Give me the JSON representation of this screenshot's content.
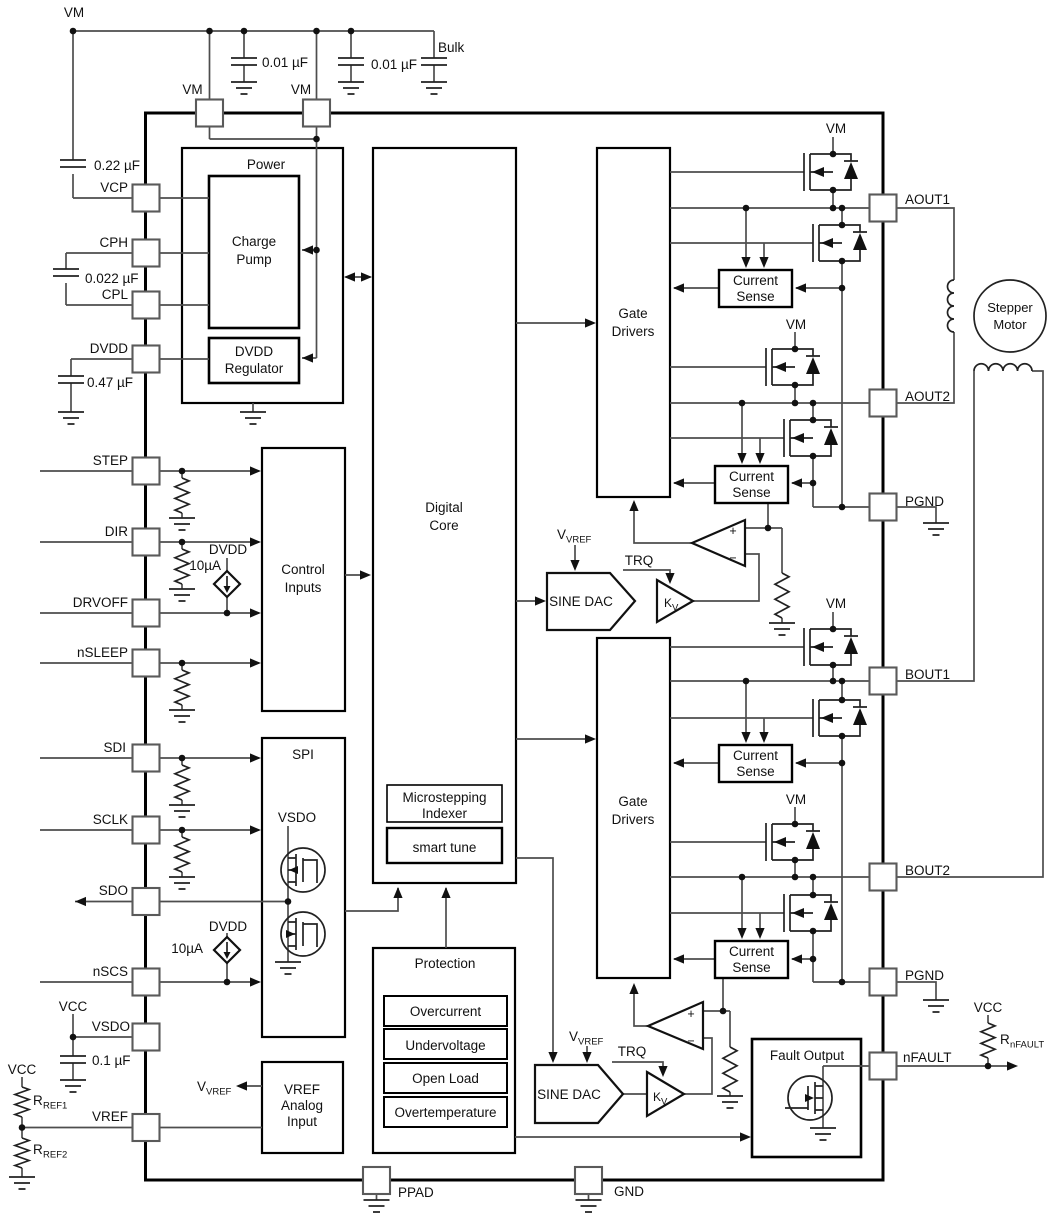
{
  "title": "Stepper motor driver functional block diagram",
  "colors": {
    "background": "#ffffff",
    "outline": "#000000",
    "wire": "#4d4d4d",
    "text": "#111111"
  },
  "labels": {
    "vm": "VM",
    "bulk": "Bulk",
    "vcc": "VCC",
    "dvdd": "DVDD",
    "i_src": "10µA",
    "trq": "TRQ",
    "plus": "+",
    "minus": "−"
  },
  "caps": {
    "c1": "0.01 µF",
    "c2": "0.01 µF",
    "c_vcp": "0.22 µF",
    "c_cp": "0.022 µF",
    "c_dvdd": "0.47 µF",
    "c_vsdo": "0.1 µF"
  },
  "pins": {
    "left": [
      "VCP",
      "CPH",
      "CPL",
      "DVDD",
      "STEP",
      "DIR",
      "DRVOFF",
      "nSLEEP",
      "SDI",
      "SCLK",
      "SDO",
      "nSCS",
      "VSDO",
      "VREF"
    ],
    "right": [
      "AOUT1",
      "AOUT2",
      "PGND",
      "BOUT1",
      "BOUT2",
      "PGND",
      "nFAULT"
    ],
    "top": [
      "VM",
      "VM"
    ],
    "bottom": [
      "PPAD",
      "GND"
    ]
  },
  "blocks": {
    "power": "Power",
    "charge_pump": [
      "Charge",
      "Pump"
    ],
    "dvdd_regulator": [
      "DVDD",
      "Regulator"
    ],
    "digital_core": [
      "Digital",
      "Core"
    ],
    "gate_drivers": [
      "Gate",
      "Drivers"
    ],
    "control_inputs": [
      "Control",
      "Inputs"
    ],
    "spi": "SPI",
    "spi_vsdo": "VSDO",
    "vref_analog": [
      "VREF",
      "Analog",
      "Input"
    ],
    "protection": "Protection",
    "protection_items": [
      "Overcurrent",
      "Undervoltage",
      "Open Load",
      "Overtemperature"
    ],
    "indexer": [
      "Microstepping",
      "Indexer"
    ],
    "smart_tune": "smart tune",
    "current_sense": [
      "Current",
      "Sense"
    ],
    "sine_dac": "SINE DAC",
    "fault_output": "Fault Output",
    "stepper_motor": [
      "Stepper",
      "Motor"
    ]
  },
  "sub_labels": {
    "vvref": {
      "main": "V",
      "sub": "VREF"
    },
    "kv": {
      "main": "K",
      "sub": "V"
    },
    "rref1": {
      "main": "R",
      "sub": "REF1"
    },
    "rref2": {
      "main": "R",
      "sub": "REF2"
    },
    "rnfault": {
      "main": "R",
      "sub": "nFAULT"
    }
  }
}
